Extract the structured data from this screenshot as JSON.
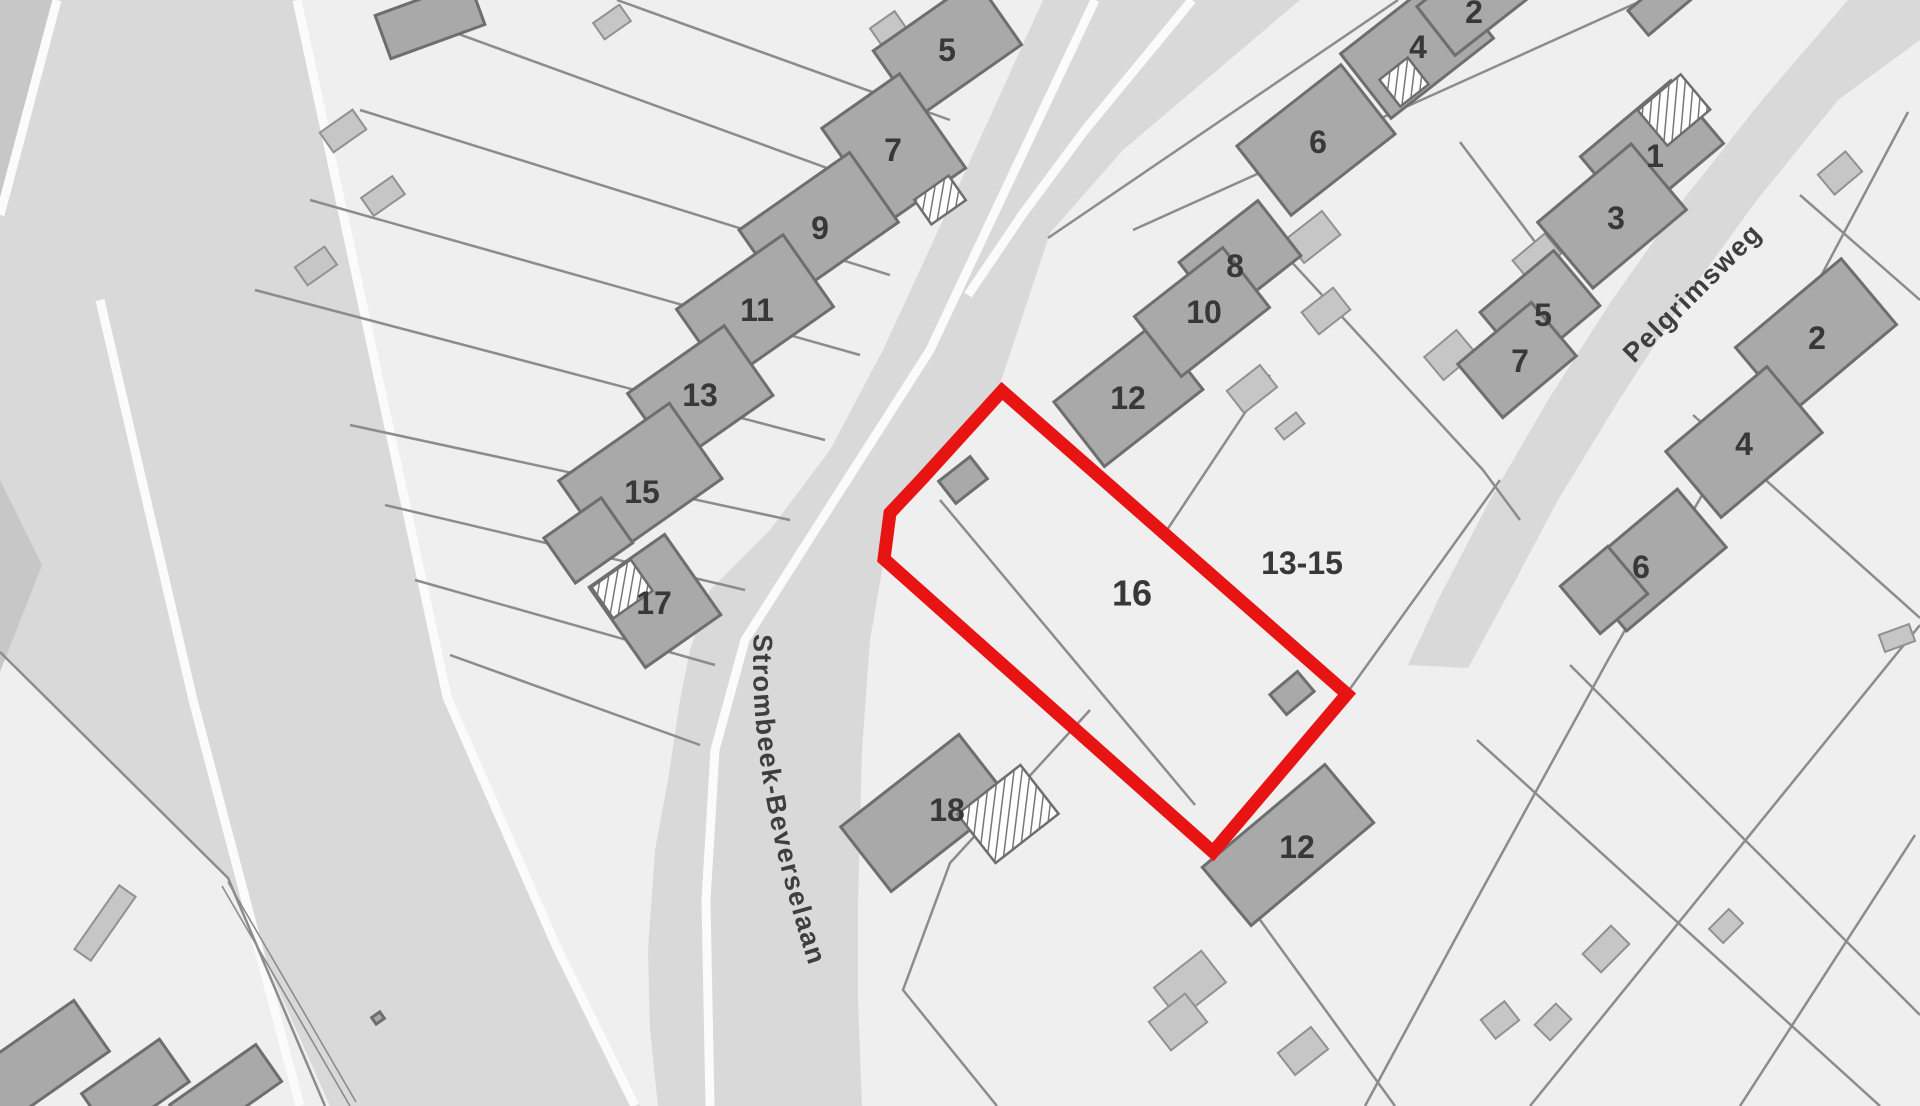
{
  "map": {
    "type": "cadastral-parcel-map",
    "highlighted_parcel": {
      "label": "16",
      "outline_color": "#e81313"
    },
    "colors": {
      "background": "#efefef",
      "road": "#d9d9d9",
      "road_dark": "#c7c7c7",
      "building_fill": "#a9a9a9",
      "building_stroke": "#6e6e6e",
      "outbuilding_fill": "#c6c6c6",
      "parcel_line": "#8c8c8c",
      "label_text": "#383838"
    },
    "street_labels": [
      {
        "text": "Strombeek-Beverselaan"
      },
      {
        "text": "Pelgrimsweg"
      }
    ],
    "parcel_labels": [
      {
        "text": "5",
        "x": 947,
        "y": 50,
        "size": 32,
        "name": "house-number-5-west"
      },
      {
        "text": "7",
        "x": 893,
        "y": 150,
        "size": 32,
        "name": "house-number-7-west"
      },
      {
        "text": "9",
        "x": 820,
        "y": 228,
        "size": 32,
        "name": "house-number-9"
      },
      {
        "text": "11",
        "x": 757,
        "y": 310,
        "size": 32,
        "name": "house-number-11"
      },
      {
        "text": "13",
        "x": 700,
        "y": 395,
        "size": 32,
        "name": "house-number-13"
      },
      {
        "text": "15",
        "x": 642,
        "y": 492,
        "size": 32,
        "name": "house-number-15"
      },
      {
        "text": "17",
        "x": 654,
        "y": 603,
        "size": 32,
        "name": "house-number-17"
      },
      {
        "text": "18",
        "x": 947,
        "y": 810,
        "size": 32,
        "name": "house-number-18"
      },
      {
        "text": "12",
        "x": 1128,
        "y": 398,
        "size": 32,
        "name": "house-number-12-upper"
      },
      {
        "text": "8",
        "x": 1235,
        "y": 266,
        "size": 32,
        "name": "house-number-8"
      },
      {
        "text": "10",
        "x": 1204,
        "y": 312,
        "size": 32,
        "name": "house-number-10"
      },
      {
        "text": "6",
        "x": 1318,
        "y": 142,
        "size": 32,
        "name": "house-number-6-upper"
      },
      {
        "text": "4",
        "x": 1418,
        "y": 47,
        "size": 32,
        "name": "house-number-4-upper"
      },
      {
        "text": "2",
        "x": 1474,
        "y": 12,
        "size": 32,
        "name": "house-number-2-upper"
      },
      {
        "text": "16",
        "x": 1132,
        "y": 593,
        "size": 36,
        "name": "highlighted-parcel-number"
      },
      {
        "text": "13-15",
        "x": 1302,
        "y": 563,
        "size": 32,
        "name": "parcel-ref-13-15"
      },
      {
        "text": "12",
        "x": 1297,
        "y": 847,
        "size": 32,
        "name": "house-number-12-lower"
      },
      {
        "text": "1",
        "x": 1655,
        "y": 156,
        "size": 32,
        "name": "house-number-1"
      },
      {
        "text": "3",
        "x": 1616,
        "y": 218,
        "size": 32,
        "name": "house-number-3"
      },
      {
        "text": "5",
        "x": 1543,
        "y": 315,
        "size": 32,
        "name": "house-number-5-east"
      },
      {
        "text": "7",
        "x": 1520,
        "y": 361,
        "size": 32,
        "name": "house-number-7-east"
      },
      {
        "text": "2",
        "x": 1817,
        "y": 338,
        "size": 32,
        "name": "house-number-2-east"
      },
      {
        "text": "4",
        "x": 1744,
        "y": 444,
        "size": 32,
        "name": "house-number-4-east"
      },
      {
        "text": "6",
        "x": 1641,
        "y": 567,
        "size": 32,
        "name": "house-number-6-east"
      }
    ]
  }
}
